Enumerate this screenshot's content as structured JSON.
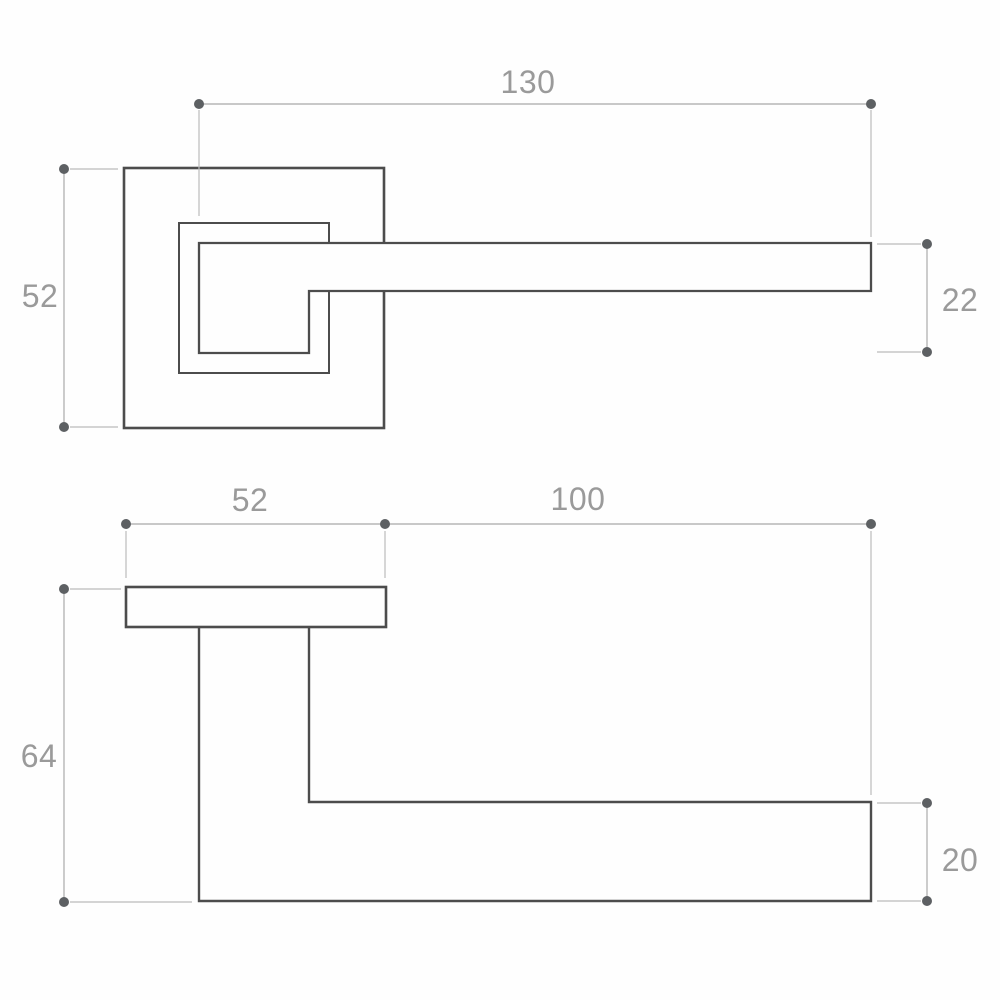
{
  "drawing": {
    "type": "technical-drawing",
    "subject": "door-lever-handle-two-views",
    "background": "#fefefe",
    "colors": {
      "object_line": "#4c4c4c",
      "dimension_line": "#b6b6b6",
      "dimension_dot": "#5d6063",
      "dimension_text": "#9a9a9a"
    },
    "front_view": {
      "dim_lever_length": "130",
      "dim_rose_size": "52",
      "dim_lever_height": "22"
    },
    "side_view": {
      "dim_rose_width": "52",
      "dim_projection": "100",
      "dim_total_depth": "64",
      "dim_lever_thickness": "20"
    }
  }
}
